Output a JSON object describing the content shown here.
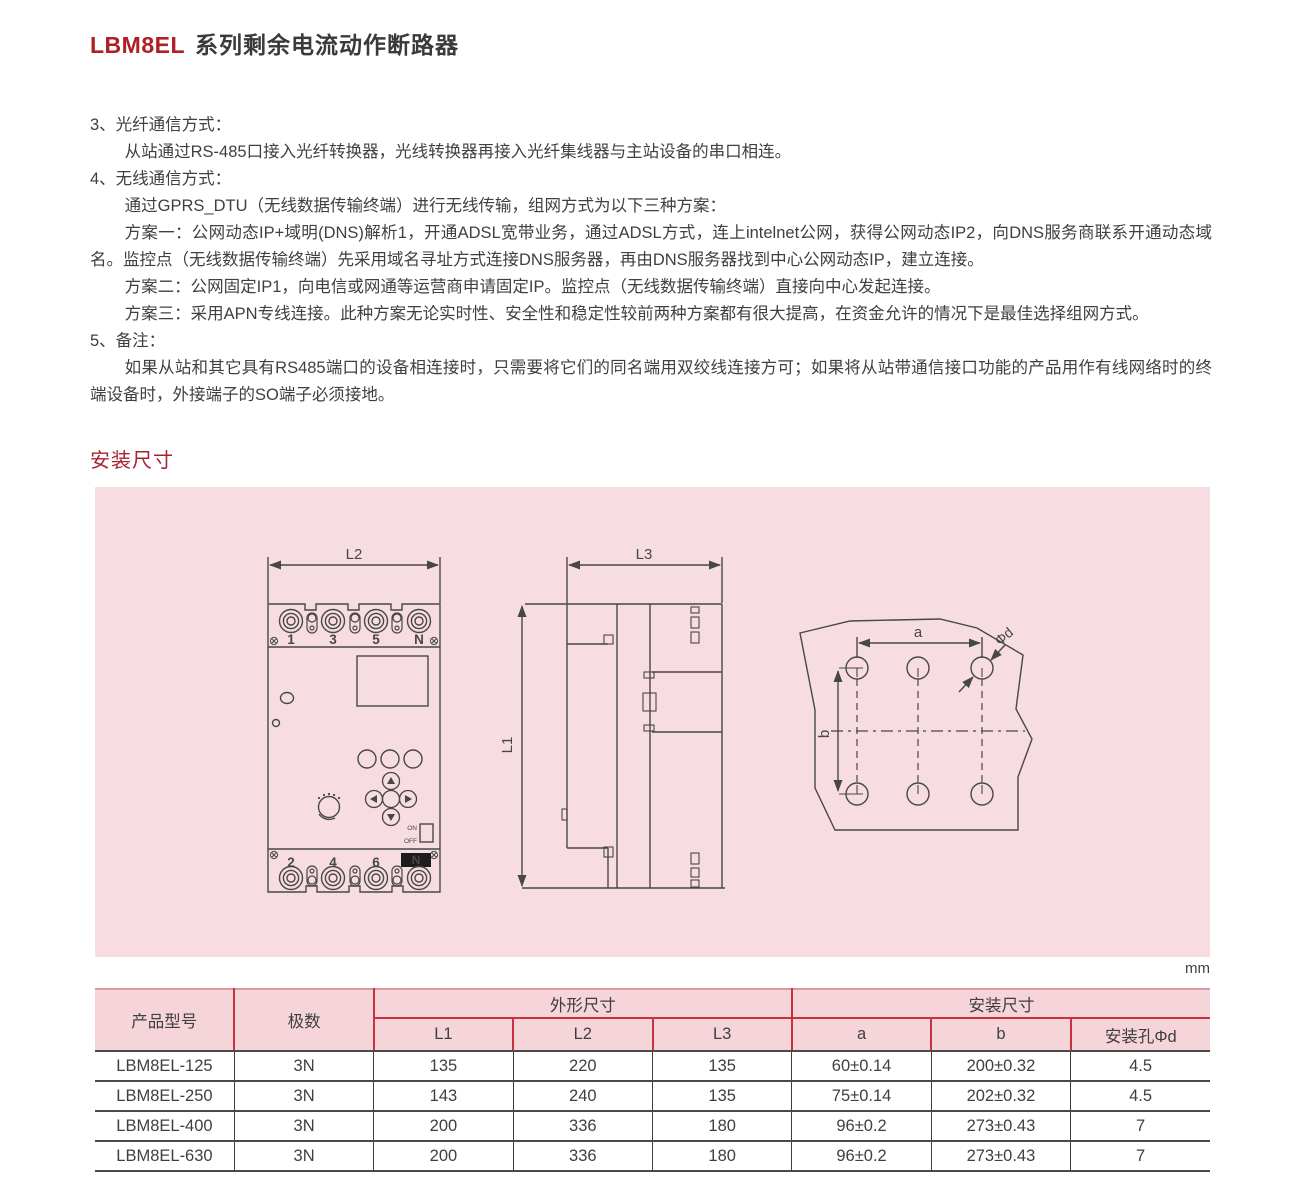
{
  "title": {
    "model": "LBM8EL",
    "rest": "系列剩余电流动作断路器"
  },
  "paragraphs": {
    "p1": "3、光纤通信方式：",
    "p2": "从站通过RS-485口接入光纤转换器，光线转换器再接入光纤集线器与主站设备的串口相连。",
    "p3": "4、无线通信方式：",
    "p4": "通过GPRS_DTU（无线数据传输终端）进行无线传输，组网方式为以下三种方案：",
    "p5": "方案一：公网动态IP+域明(DNS)解析1，开通ADSL宽带业务，通过ADSL方式，连上intelnet公网，获得公网动态IP2，向DNS服务商联系开通动态域名。监控点（无线数据传输终端）先采用域名寻址方式连接DNS服务器，再由DNS服务器找到中心公网动态IP，建立连接。",
    "p6": "方案二：公网固定IP1，向电信或网通等运营商申请固定IP。监控点（无线数据传输终端）直接向中心发起连接。",
    "p7": "方案三：采用APN专线连接。此种方案无论实时性、安全性和稳定性较前两种方案都有很大提高，在资金允许的情况下是最佳选择组网方式。",
    "p8": "5、备注：",
    "p9": "如果从站和其它具有RS485端口的设备相连接时，只需要将它们的同名端用双绞线连接方可；如果将从站带通信接口功能的产品用作有线网络时的终端设备时，外接端子的SO端子必须接地。"
  },
  "section_heading": "安装尺寸",
  "unit_label": "mm",
  "diagram": {
    "labels": {
      "l1": "L1",
      "l2": "L2",
      "l3": "L3",
      "a": "a",
      "b": "b",
      "phid": "Φd",
      "on": "ON",
      "off": "OFF"
    },
    "front": {
      "top_terminals": [
        "1",
        "3",
        "5",
        "N"
      ],
      "bottom_terminals": [
        "2",
        "4",
        "6"
      ],
      "neutral_badge": "N"
    }
  },
  "table": {
    "header": {
      "product": "产品型号",
      "poles": "极数",
      "outline_group": "外形尺寸",
      "mounting_group": "安装尺寸",
      "sub": [
        "L1",
        "L2",
        "L3",
        "a",
        "b",
        "安装孔Φd"
      ]
    },
    "rows": [
      {
        "model": "LBM8EL-125",
        "poles": "3N",
        "l1": "135",
        "l2": "220",
        "l3": "135",
        "a": "60±0.14",
        "b": "200±0.32",
        "d": "4.5"
      },
      {
        "model": "LBM8EL-250",
        "poles": "3N",
        "l1": "143",
        "l2": "240",
        "l3": "135",
        "a": "75±0.14",
        "b": "202±0.32",
        "d": "4.5"
      },
      {
        "model": "LBM8EL-400",
        "poles": "3N",
        "l1": "200",
        "l2": "336",
        "l3": "180",
        "a": "96±0.2",
        "b": "273±0.43",
        "d": "7"
      },
      {
        "model": "LBM8EL-630",
        "poles": "3N",
        "l1": "200",
        "l2": "336",
        "l3": "180",
        "a": "96±0.2",
        "b": "273±0.43",
        "d": "7"
      }
    ]
  },
  "colors": {
    "title_accent": "#b01f26",
    "heading_red": "#a82331",
    "panel_pink": "#f7dde1",
    "table_header_pink": "#f5d5da",
    "red_rule": "#c9323c",
    "dark_rule": "#4a4a4a",
    "line": "#474747"
  }
}
